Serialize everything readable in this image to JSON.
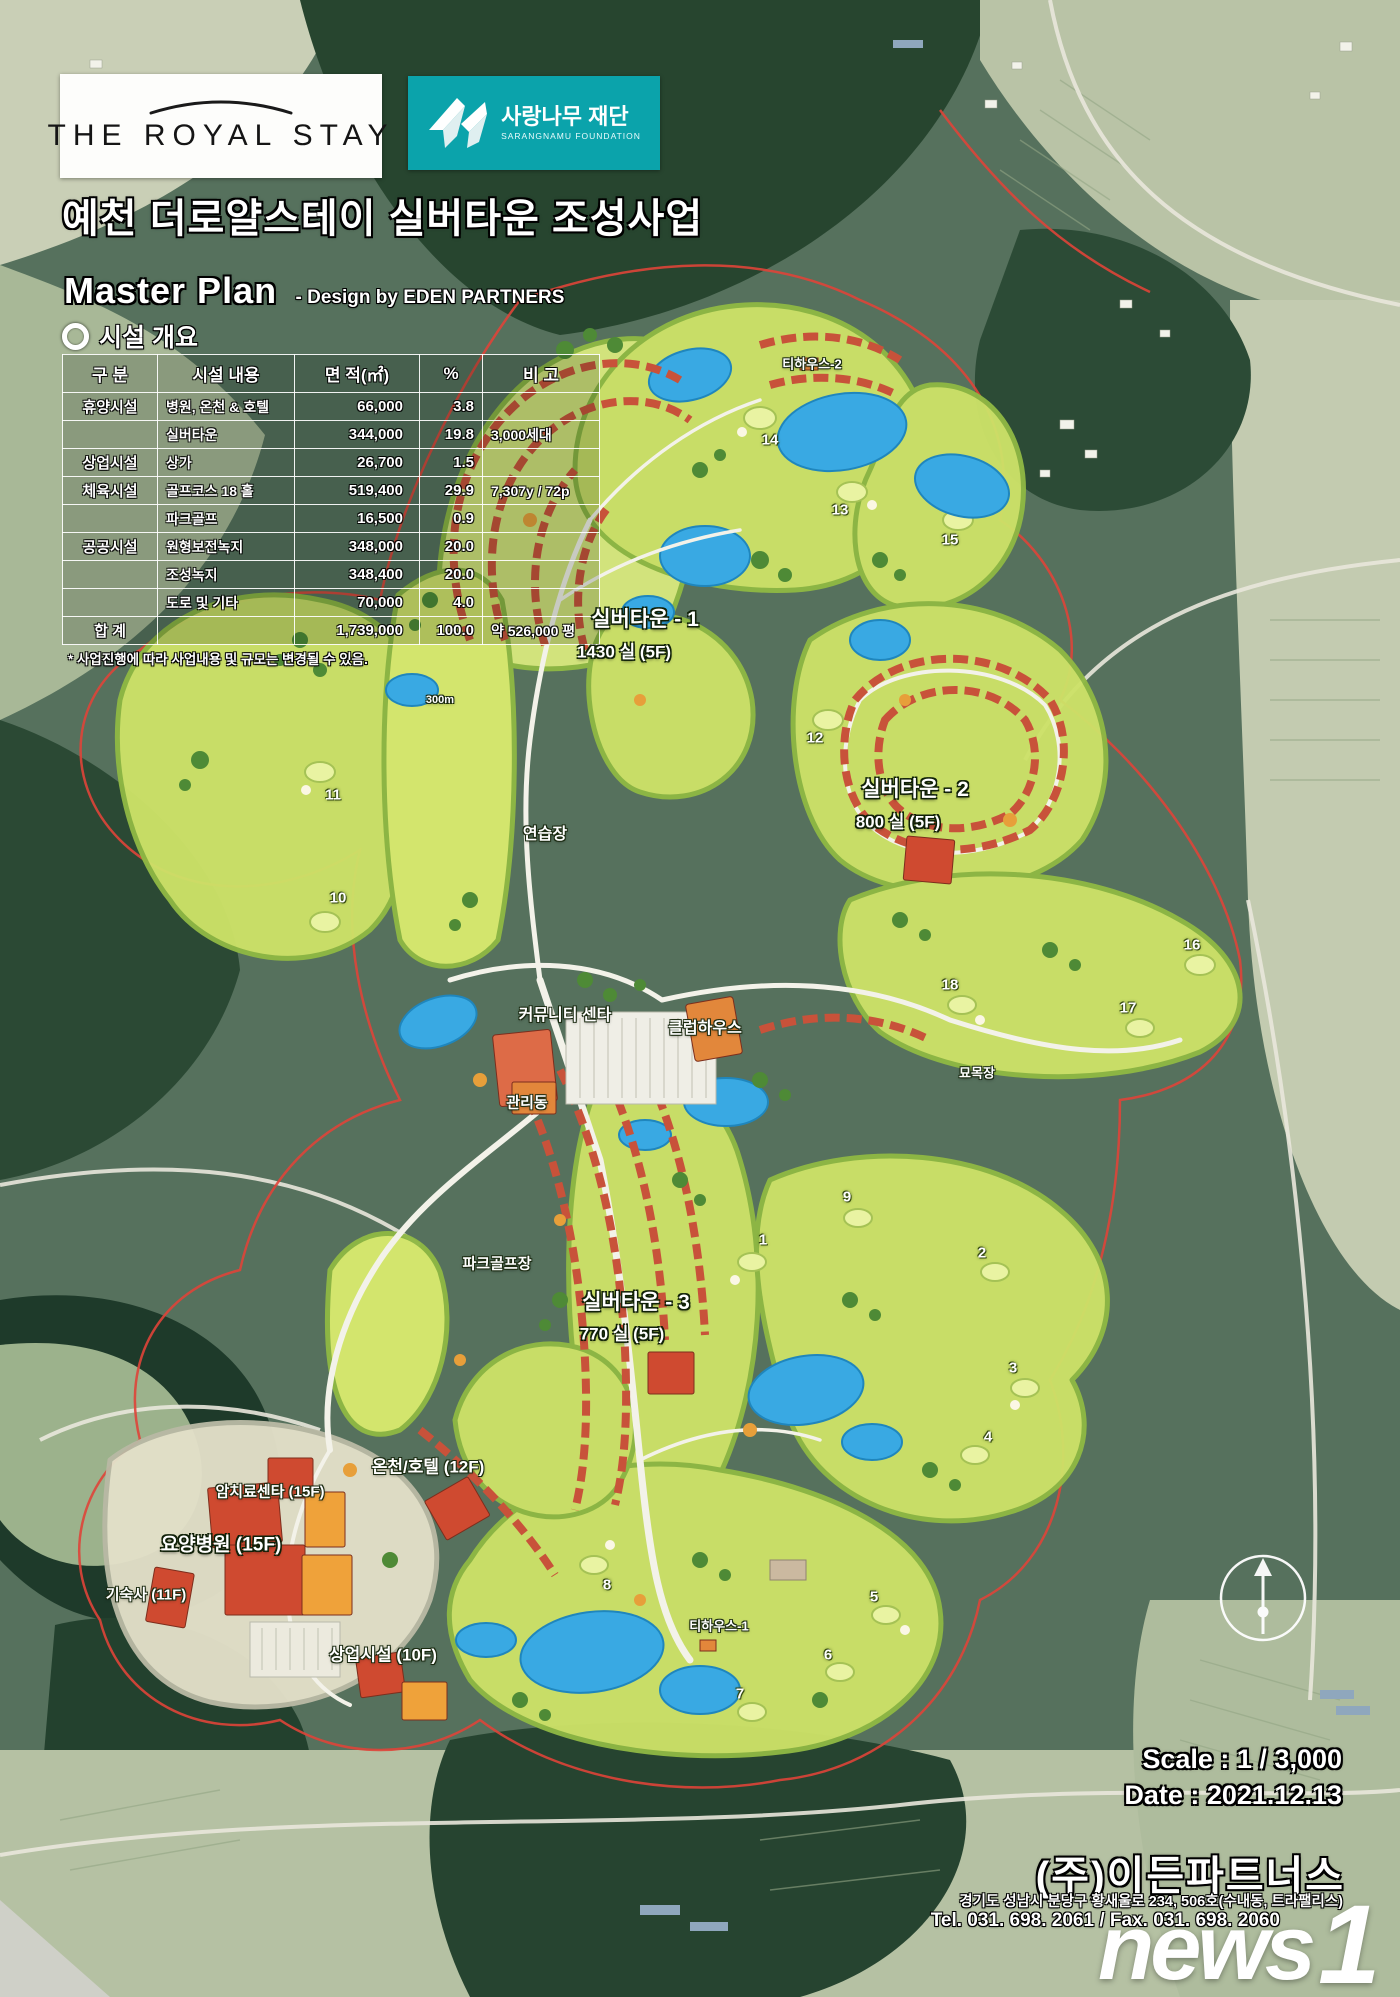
{
  "header": {
    "brand": "THE ROYAL STAY",
    "foundation_name": "사랑나무 재단",
    "foundation_sub": "SARANGNAMU FOUNDATION",
    "title": "예천 더로얄스테이 실버타운 조성사업",
    "master_plan": "Master Plan",
    "design_by": "- Design by EDEN PARTNERS"
  },
  "facility_table": {
    "section_title": "시설 개요",
    "columns": [
      "구 분",
      "시설 내용",
      "면 적(㎡)",
      "%",
      "비 고"
    ],
    "rows": [
      [
        "휴양시설",
        "병원, 온천 & 호텔",
        "66,000",
        "3.8",
        ""
      ],
      [
        "",
        "실버타운",
        "344,000",
        "19.8",
        "3,000세대"
      ],
      [
        "상업시설",
        "상가",
        "26,700",
        "1.5",
        ""
      ],
      [
        "체육시설",
        "골프코스 18 홀",
        "519,400",
        "29.9",
        "7,307y / 72p"
      ],
      [
        "",
        "파크골프",
        "16,500",
        "0.9",
        ""
      ],
      [
        "공공시설",
        "원형보전녹지",
        "348,000",
        "20.0",
        ""
      ],
      [
        "",
        "조성녹지",
        "348,400",
        "20.0",
        ""
      ],
      [
        "",
        "도로 및 기타",
        "70,000",
        "4.0",
        ""
      ],
      [
        "합 계",
        "",
        "1,739,000",
        "100.0",
        "약 526,000 평"
      ]
    ],
    "footnote": "* 사업진행에 따라 사업내용 및 규모는 변경될 수 있음."
  },
  "map_labels": [
    {
      "name": "teahouse-2-label",
      "text": "티하우스-2",
      "x": 812,
      "y": 363,
      "size": 13
    },
    {
      "name": "silvertown-1-label",
      "text": "실버타운 - 1",
      "x": 645,
      "y": 618,
      "size": 21,
      "big": true
    },
    {
      "name": "silvertown-1-units",
      "text": "1430 실 (5F)",
      "x": 624,
      "y": 650,
      "size": 17,
      "big": true
    },
    {
      "name": "range-distance-label",
      "text": "300m",
      "x": 440,
      "y": 700,
      "size": 11
    },
    {
      "name": "silvertown-2-label",
      "text": "실버타운 - 2",
      "x": 915,
      "y": 788,
      "size": 21,
      "big": true
    },
    {
      "name": "silvertown-2-units",
      "text": "800 실 (5F)",
      "x": 898,
      "y": 820,
      "size": 17,
      "big": true
    },
    {
      "name": "driving-range-label",
      "text": "연습장",
      "x": 545,
      "y": 832,
      "size": 16
    },
    {
      "name": "community-center-label",
      "text": "커뮤니티 센타",
      "x": 565,
      "y": 1013,
      "size": 16
    },
    {
      "name": "clubhouse-label",
      "text": "클럽하우스",
      "x": 705,
      "y": 1026,
      "size": 16
    },
    {
      "name": "admin-building-label",
      "text": "관리동",
      "x": 527,
      "y": 1102,
      "size": 15
    },
    {
      "name": "nursery-label",
      "text": "묘목장",
      "x": 977,
      "y": 1072,
      "size": 13
    },
    {
      "name": "park-golf-label",
      "text": "파크골프장",
      "x": 497,
      "y": 1263,
      "size": 15
    },
    {
      "name": "silvertown-3-label",
      "text": "실버타운 - 3",
      "x": 636,
      "y": 1301,
      "size": 21,
      "big": true
    },
    {
      "name": "silvertown-3-units",
      "text": "770 실 (5F)",
      "x": 622,
      "y": 1332,
      "size": 17,
      "big": true
    },
    {
      "name": "spa-hotel-label",
      "text": "온천/호텔 (12F)",
      "x": 428,
      "y": 1465,
      "size": 17
    },
    {
      "name": "cancer-center-label",
      "text": "암치료센타 (15F)",
      "x": 270,
      "y": 1491,
      "size": 15
    },
    {
      "name": "nursing-hospital-label",
      "text": "요양병원 (15F)",
      "x": 221,
      "y": 1543,
      "size": 19,
      "big": true
    },
    {
      "name": "dormitory-label",
      "text": "기숙사 (11F)",
      "x": 146,
      "y": 1594,
      "size": 15
    },
    {
      "name": "commercial-label",
      "text": "상업시설 (10F)",
      "x": 383,
      "y": 1653,
      "size": 17
    },
    {
      "name": "teahouse-1-label",
      "text": "티하우스-1",
      "x": 719,
      "y": 1625,
      "size": 13
    }
  ],
  "hole_numbers": [
    {
      "n": "14",
      "x": 770,
      "y": 440
    },
    {
      "n": "13",
      "x": 840,
      "y": 510
    },
    {
      "n": "15",
      "x": 950,
      "y": 540
    },
    {
      "n": "12",
      "x": 815,
      "y": 738
    },
    {
      "n": "11",
      "x": 333,
      "y": 795
    },
    {
      "n": "10",
      "x": 338,
      "y": 898
    },
    {
      "n": "16",
      "x": 1192,
      "y": 945
    },
    {
      "n": "18",
      "x": 950,
      "y": 985
    },
    {
      "n": "17",
      "x": 1128,
      "y": 1008
    },
    {
      "n": "9",
      "x": 847,
      "y": 1197
    },
    {
      "n": "1",
      "x": 763,
      "y": 1240
    },
    {
      "n": "2",
      "x": 982,
      "y": 1253
    },
    {
      "n": "3",
      "x": 1013,
      "y": 1368
    },
    {
      "n": "4",
      "x": 988,
      "y": 1437
    },
    {
      "n": "5",
      "x": 874,
      "y": 1597
    },
    {
      "n": "6",
      "x": 828,
      "y": 1655
    },
    {
      "n": "7",
      "x": 740,
      "y": 1694
    },
    {
      "n": "8",
      "x": 607,
      "y": 1585
    }
  ],
  "footer": {
    "scale": "Scale : 1 / 3,000",
    "date": "Date : 2021.12.13",
    "company": "(주)이든파트너스",
    "address": "경기도 성남시 분당구 황새울로 234, 506호(수내동, 트라팰리스)",
    "tel_fax": "Tel. 031. 698. 2061 / Fax. 031. 698. 2060"
  },
  "watermark": {
    "news": "news",
    "one": "1"
  },
  "colors": {
    "foundation_teal": "#0ba3ab",
    "housing_red": "#c8523a",
    "fairway_green": "#cde268",
    "pond_blue": "#39a9e3",
    "boundary_red": "#df4438"
  }
}
